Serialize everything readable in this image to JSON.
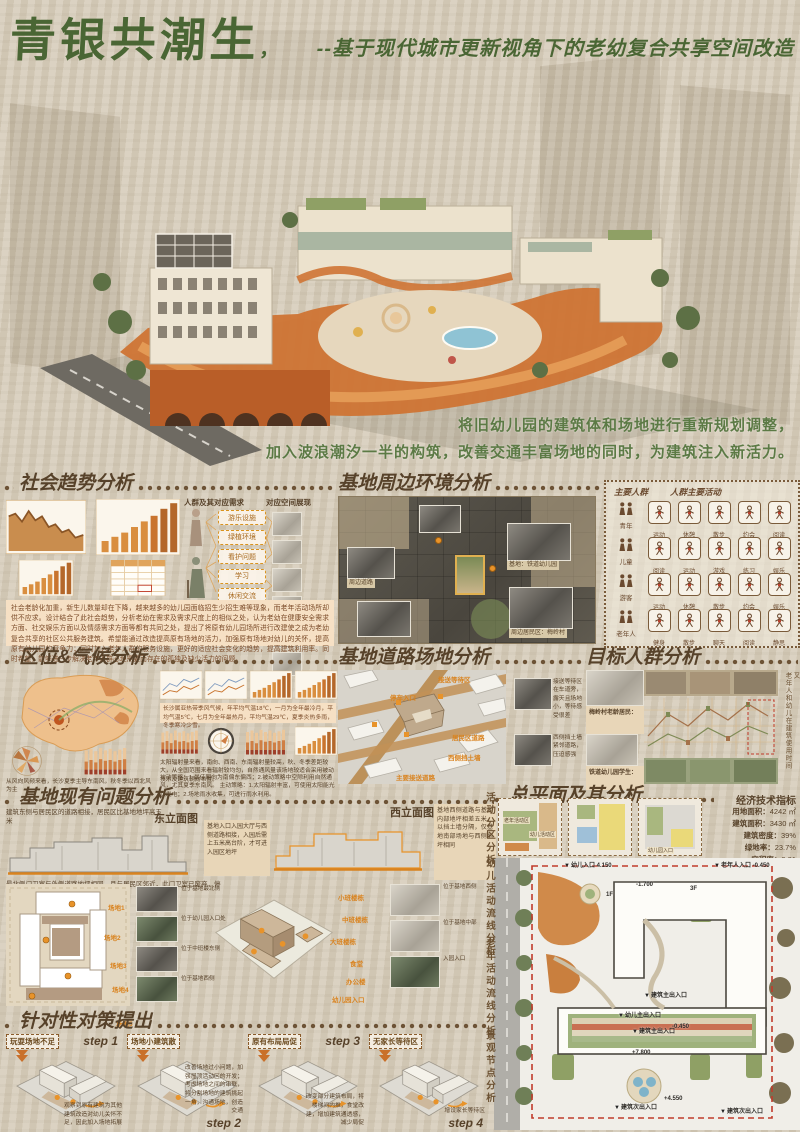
{
  "poster": {
    "title": "青银共潮生",
    "title_mark": "，",
    "subtitle": "--基于现代城市更新视角下的老幼复合共享空间改造",
    "intro_line1": "将旧幼儿园的建筑体和场地进行重新规划调整，",
    "intro_line2": "加入波浪潮汐一半的构筑，改善交通丰富场地的同时，为建筑注入新活力。"
  },
  "colors": {
    "title_green": "#4a6634",
    "header_brown": "#57422a",
    "accent_orange": "#d9831f",
    "panel_peach": "#f6e0c4"
  },
  "social_trend": {
    "title": "社会趋势分析",
    "flow_left_title": "人群及其对应需求",
    "flow_right_title": "对应空间展现",
    "needs": [
      "游乐设施",
      "绿植环境",
      "看护问题",
      "学习",
      "休闲交流",
      "陪伴"
    ],
    "paragraph": "社会老龄化加重，新生儿数量却在下降，越来越多的幼儿园面临招生少招生难等现象，而老年活动场所却供不应求。设计结合了此社会趋势，分析老幼在需求及需求尺度上的相似之处，认为老幼在健康安全需求方面、社交娱乐方面以及情感需求方面等都有共同之处，提出了将原有幼儿园场所进行改建使之成为老幼复合共享的社区公共服务建筑。希望能通过改造提高原有场地的活力，加强原有场地对幼儿的关怀，提高原有幼儿园的竞争力；同时加入老年人群的服务设施，更好的适应社会变化的趋势，提高建筑利用率。同时希望，能够进一步解决老年人群心理需要而存在的孤独及缺少活力的问题。"
  },
  "surrounding": {
    "title": "基地周边环境分析",
    "captions": [
      "基地：铁道幼儿园",
      "周边居民区：梅岭村",
      "周边道路"
    ]
  },
  "audiences": {
    "col1_title": "主要人群",
    "col2_title": "人群主要活动",
    "rows": [
      {
        "group": "青年",
        "acts": [
          "运动",
          "休憩",
          "散步",
          "约会",
          "阅读"
        ]
      },
      {
        "group": "儿童",
        "acts": [
          "阅读",
          "运动",
          "游戏",
          "练习",
          "娱乐"
        ]
      },
      {
        "group": "游客",
        "acts": [
          "运动",
          "休憩",
          "散步",
          "约会",
          "娱乐"
        ]
      },
      {
        "group": "老年人",
        "acts": [
          "健身",
          "散步",
          "聊天",
          "阅读",
          "静思"
        ]
      }
    ]
  },
  "location_climate": {
    "title": "区位&气候分析",
    "notes": [
      "长沙属亚热带季风气候，年平均气温18℃，一月为全年最冷月，平均气温5℃，七月为全年最热月，平均气温29℃，夏季炎热多雨，冬季寒冷少雪。",
      "太阳辐射量来看，南向、西南、东南辐射量较高，秋、冬季差距较大，从全国范围来看辐射较均匀，自然通风量该场地较适合采用被动技术及建筑朝向布置。",
      "被动策略：1.最佳朝向为南偏东偏西；2.被动策略中空隙利用自然通风，尤其夏季东南风。 主动策略：1.太阳辐射丰富，可使用太阳能光伏发电；2.场地雨水收集，可进行雨水利用。",
      "从风向风频来看，长沙夏季主导东南风，秋冬季以西北风为主"
    ]
  },
  "site_roads": {
    "title": "基地道路场地分析",
    "axon_labels": [
      "接送等待区",
      "停车入口",
      "居民区道路",
      "西侧挡土墙",
      "主要接送道路"
    ],
    "photo_captions": [
      "接送等待区在车道旁，露天且场地小，等待感受很差",
      "西侧挡土墙紧邻道路，压迫感强"
    ]
  },
  "target_groups": {
    "title": "目标人群分析",
    "profiles": [
      {
        "name": "梅岭村老龄居民："
      },
      {
        "name": "铁道幼儿园学生："
      }
    ],
    "note_line1": "老年人和幼儿在建筑使用时间",
    "note_line2": "在每天的晚上六点到九点不存在交叉"
  },
  "site_problems": {
    "title": "基地现有问题分析",
    "east_elevation": "东立面图",
    "west_elevation": "西立面图",
    "note_east": "建筑东侧与居民区的道路相接，居民区比基地地坪高五米",
    "note_north": "最北侧门卫室与外侧道路地坪相同，且与居民区邻近，此门卫室已废弃，停止使用",
    "note_entry": "基地入口入园大厅与西侧道路相接，入园后需上五米高台阶，才可进入园区地坪",
    "note_west": "基地西侧道路与基地内部地坪相差五米，以挡土墙分隔，仅基地南部场地与西侧地坪相同",
    "site_labels": [
      "场地1",
      "场地2",
      "场地3",
      "场地4",
      "场地5"
    ],
    "building_labels": [
      "小班楼栋",
      "中班楼栋",
      "大班楼栋",
      "食堂",
      "办公楼",
      "幼儿园入口"
    ],
    "photo_captions": [
      "位于基地最北侧",
      "位于幼儿园入口处",
      "位于中班楼东侧",
      "位于基地西侧",
      "位于基地中部",
      "入园入口"
    ]
  },
  "master_plan": {
    "title": "总平面及其分析",
    "indicators_title": "经济技术指标",
    "indicators": [
      {
        "label": "用地面积：",
        "value": "4242 ㎡"
      },
      {
        "label": "建筑面积：",
        "value": "3430 ㎡"
      },
      {
        "label": "建筑密度：",
        "value": "39%"
      },
      {
        "label": "绿地率：",
        "value": "23.7%"
      },
      {
        "label": "容积率：",
        "value": "0.81"
      }
    ],
    "zone_labels": [
      "老年活动区",
      "幼儿活动区",
      "幼儿园入口"
    ],
    "plan_labels": [
      "幼儿入口 4.150",
      "老年人入口 -0.450",
      "建筑主出入口",
      "幼儿主出入口",
      "-0.450",
      "建筑主出入口",
      "+7.800",
      "+4.550",
      "建筑次出入口",
      "建筑次出入口",
      "-1.700",
      "1F",
      "3F"
    ]
  },
  "strategies": {
    "title": "针对性对策提出",
    "steps": [
      {
        "tag": "玩耍场地不足",
        "step": "step 1",
        "note": "观察到原有建筑为其他建筑改造对幼儿关怀不足，因此加入场地拓展"
      },
      {
        "tag": "场地小建筑散",
        "step": "step 2",
        "note": "改善场地过小问题，加强屋顶活动区的开发；考虑场地之间的串联，将分割场地的建筑挑起一角，沟通场地，创造交通"
      },
      {
        "tag": "原有布局局促",
        "step": "step 3",
        "note": "改变部分建筑布局，将楼梯间内推，食堂改建，增加建筑通透感，减少局促"
      },
      {
        "tag": "无家长等待区",
        "step": "step 4",
        "note": "增设家长等待区"
      }
    ]
  },
  "side_labels": [
    "活动分区分析",
    "幼儿活动流线分析",
    "老年活动流线分析",
    "景观节点分析"
  ]
}
